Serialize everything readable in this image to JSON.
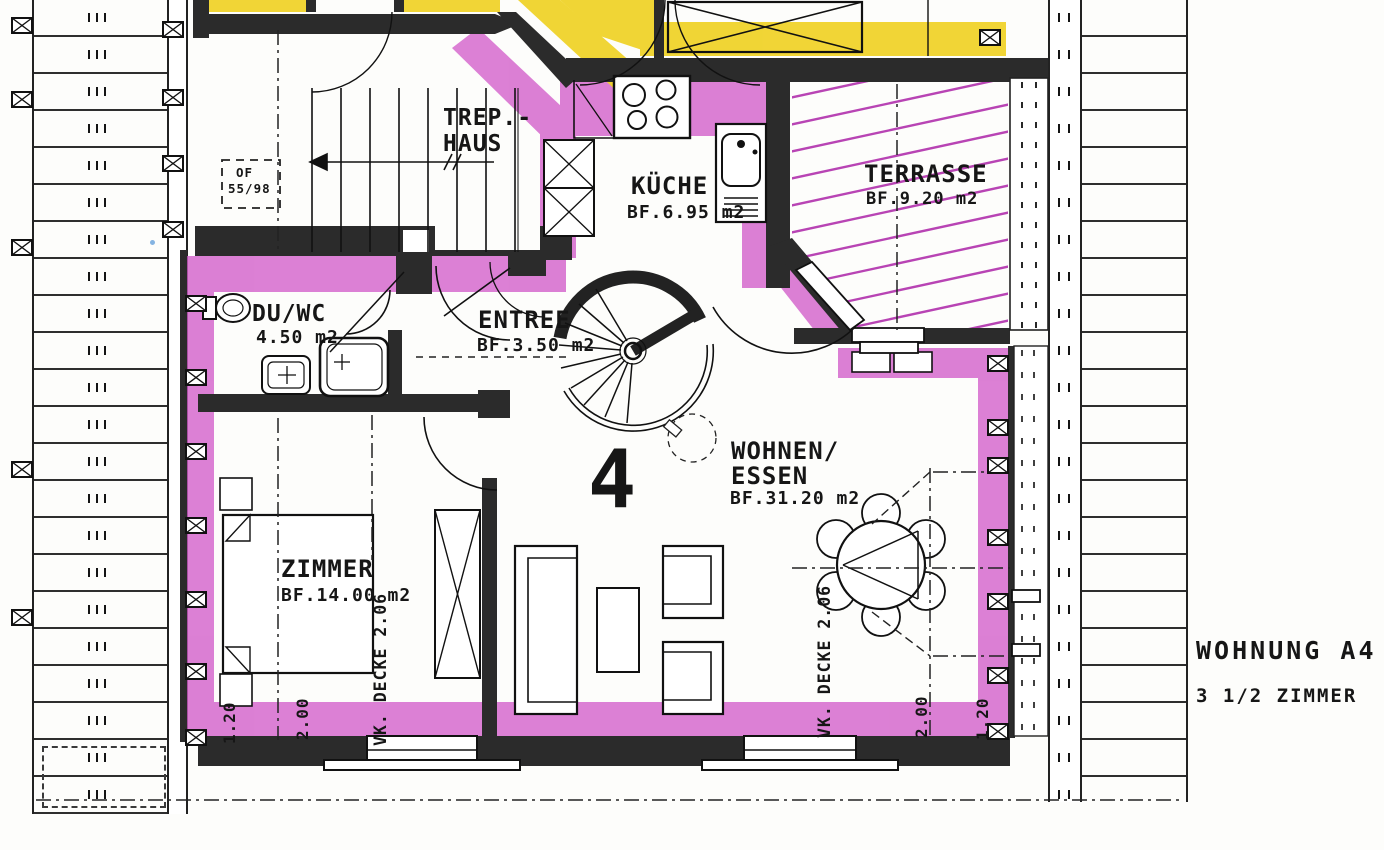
{
  "header": {
    "unit_label": "WOHNUNG A4",
    "size_label": "3 1/2 ZIMMER"
  },
  "plan": {
    "unit_number": "4",
    "rooms": {
      "trephaus": {
        "name_line1": "TREP.-",
        "name_line2": "HAUS"
      },
      "kueche": {
        "name": "KÜCHE",
        "area": "BF.6.95 m2"
      },
      "terrasse": {
        "name": "TERRASSE",
        "area": "BF.9.20 m2"
      },
      "duwc": {
        "name": "DU/WC",
        "area": "4.50 m2"
      },
      "entree": {
        "name": "ENTREE",
        "area": "BF.3.50 m2"
      },
      "wohnen": {
        "name_line1": "WOHNEN/",
        "name_line2": "ESSEN",
        "area": "BF.31.20 m2"
      },
      "zimmer": {
        "name": "ZIMMER",
        "area": "BF.14.00 m2"
      }
    },
    "annotations": {
      "roof_window_line1": "OF",
      "roof_window_line2": "55/98",
      "ceiling_height_left": "VK. DECKE 2.06",
      "ceiling_height_right": "VK. DECKE 2.06",
      "dim_left_outer": "1.20",
      "dim_left_inner": "2.00",
      "dim_right_inner": "2.00",
      "dim_right_outer": "1.20"
    },
    "colors": {
      "highlight_walls": "#d25cca",
      "highlight_hatch": "#b844b4",
      "highlight_neighbor": "#f0d32b",
      "walls": "#2b2b2b"
    }
  }
}
